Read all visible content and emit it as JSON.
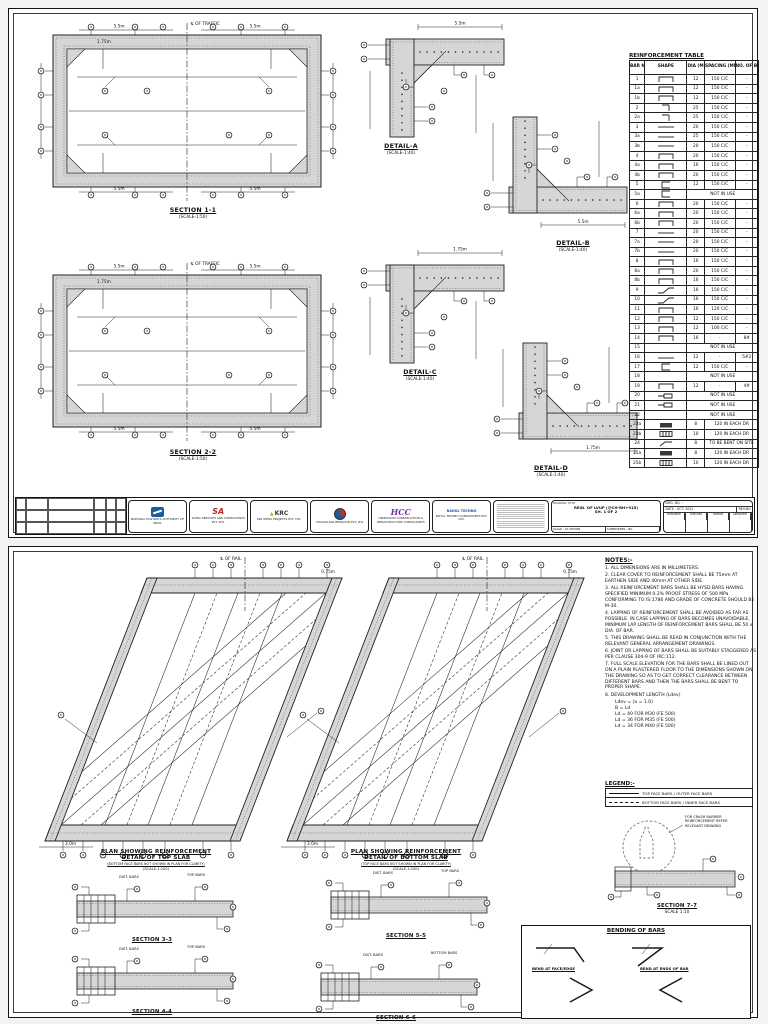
{
  "page1": {
    "s11": {
      "title": "SECTION 1-1",
      "scale": "(SCALE-1:50)",
      "centerline": "℄ OF TRAFFIC",
      "dims": {
        "a": "5.5m",
        "b": "5.5m",
        "c": "1.75m",
        "d": "5.5m",
        "e": "5.5m"
      }
    },
    "s22": {
      "title": "SECTION 2-2",
      "scale": "(SCALE-1:50)",
      "centerline": "℄ OF TRAFFIC",
      "dims": {
        "a": "5.5m",
        "b": "5.5m",
        "c": "1.75m",
        "d": "5.5m",
        "e": "5.5m"
      }
    },
    "details": {
      "a": {
        "title": "DETAIL-A",
        "scale": "(SCALE-1:40)",
        "dim": "5.5m"
      },
      "b": {
        "title": "DETAIL-B",
        "scale": "(SCALE-1:40)",
        "dim": "5.5m"
      },
      "c": {
        "title": "DETAIL-C",
        "scale": "(SCALE-1:40)",
        "dim": "1.75m"
      },
      "d": {
        "title": "DETAIL-D",
        "scale": "(SCALE-1:40)",
        "dim": "1.75m"
      }
    },
    "table": {
      "title": "REINFORCEMENT TABLE",
      "headers": [
        "BAR NO.",
        "SHAPE",
        "DIA (MM)",
        "SPACING (MM)",
        "NO. OF BARS"
      ],
      "rows": [
        {
          "no": "1",
          "shape": "u",
          "dia": "12",
          "spacing": "150 C/C",
          "bars": "-"
        },
        {
          "no": "1a",
          "shape": "u",
          "dia": "12",
          "spacing": "150 C/C",
          "bars": "-"
        },
        {
          "no": "1b",
          "shape": "u",
          "dia": "12",
          "spacing": "150 C/C",
          "bars": "-"
        },
        {
          "no": "2",
          "shape": "ldown",
          "dia": "25",
          "spacing": "150 C/C",
          "bars": "-"
        },
        {
          "no": "2a",
          "shape": "ldown",
          "dia": "25",
          "spacing": "150 C/C",
          "bars": "-"
        },
        {
          "no": "3",
          "shape": "line",
          "dia": "20",
          "spacing": "150 C/C",
          "bars": "-"
        },
        {
          "no": "3a",
          "shape": "line",
          "dia": "25",
          "spacing": "150 C/C",
          "bars": "-"
        },
        {
          "no": "3b",
          "shape": "line",
          "dia": "20",
          "spacing": "150 C/C",
          "bars": "-"
        },
        {
          "no": "4",
          "shape": "u",
          "dia": "20",
          "spacing": "150 C/C",
          "bars": "-"
        },
        {
          "no": "4a",
          "shape": "u",
          "dia": "16",
          "spacing": "150 C/C",
          "bars": "-"
        },
        {
          "no": "4b",
          "shape": "u",
          "dia": "20",
          "spacing": "150 C/C",
          "bars": "-"
        },
        {
          "no": "5",
          "shape": "c",
          "dia": "12",
          "spacing": "150 C/C",
          "bars": "-"
        },
        {
          "no": "5a",
          "shape": "c",
          "note": "NOT IN USE"
        },
        {
          "no": "6",
          "shape": "u",
          "dia": "20",
          "spacing": "150 C/C",
          "bars": "-"
        },
        {
          "no": "6a",
          "shape": "u",
          "dia": "20",
          "spacing": "150 C/C",
          "bars": "-"
        },
        {
          "no": "6b",
          "shape": "u",
          "dia": "20",
          "spacing": "150 C/C",
          "bars": "-"
        },
        {
          "no": "7",
          "shape": "line",
          "dia": "20",
          "spacing": "150 C/C",
          "bars": "-"
        },
        {
          "no": "7a",
          "shape": "line",
          "dia": "20",
          "spacing": "150 C/C",
          "bars": "-"
        },
        {
          "no": "7b",
          "shape": "line",
          "dia": "20",
          "spacing": "150 C/C",
          "bars": "-"
        },
        {
          "no": "8",
          "shape": "u",
          "dia": "16",
          "spacing": "150 C/C",
          "bars": "-"
        },
        {
          "no": "8a",
          "shape": "u",
          "dia": "20",
          "spacing": "150 C/C",
          "bars": "-"
        },
        {
          "no": "8b",
          "shape": "u",
          "dia": "16",
          "spacing": "150 C/C",
          "bars": "-"
        },
        {
          "no": "9",
          "shape": "crank",
          "dia": "16",
          "spacing": "150 C/C",
          "bars": "-"
        },
        {
          "no": "10",
          "shape": "crank",
          "dia": "16",
          "spacing": "150 C/C",
          "bars": "-"
        },
        {
          "no": "11",
          "shape": "u",
          "dia": "16",
          "spacing": "120 C/C",
          "bars": "-"
        },
        {
          "no": "12",
          "shape": "u",
          "dia": "12",
          "spacing": "150 C/C",
          "bars": "-"
        },
        {
          "no": "13",
          "shape": "u",
          "dia": "12",
          "spacing": "100 C/C",
          "bars": "-"
        },
        {
          "no": "14",
          "shape": "u",
          "dia": "16",
          "spacing": "-",
          "bars": "8#"
        },
        {
          "no": "15",
          "note": "NOT IN USE"
        },
        {
          "no": "16",
          "shape": "line",
          "dia": "12",
          "spacing": "-",
          "bars": "5#2"
        },
        {
          "no": "17",
          "shape": "c",
          "dia": "12",
          "spacing": "150 C/C",
          "bars": "-"
        },
        {
          "no": "18",
          "note": "NOT IN USE"
        },
        {
          "no": "19",
          "shape": "u",
          "dia": "12",
          "spacing": "-",
          "bars": "4#"
        },
        {
          "no": "20",
          "shape": "loop",
          "note": "NOT IN USE"
        },
        {
          "no": "21",
          "shape": "loop",
          "note": "NOT IN USE"
        },
        {
          "no": "22",
          "note": "NOT IN USE"
        },
        {
          "no": "23a",
          "shape": "plate",
          "dia": "8",
          "note2": "120 IN EACH DR"
        },
        {
          "no": "23b",
          "shape": "box",
          "dia": "10",
          "note2": "120 IN EACH DR"
        },
        {
          "no": "24",
          "shape": "tick",
          "dia": "8",
          "note2": "TO BE BENT ON SITE"
        },
        {
          "no": "25a",
          "shape": "plate",
          "dia": "8",
          "note2": "120 IN EACH DR"
        },
        {
          "no": "25b",
          "shape": "box",
          "dia": "10",
          "note2": "120 IN EACH DR"
        }
      ]
    },
    "titleblock": {
      "title_label": "DRAWING TITLE",
      "drawing_title": "REIN. OF LVUP (@CH-RH+915)",
      "sheet": "SH. 1 OF 2",
      "scale_note": "SCALE : AS SHOWN",
      "supersede": "SUPERSEDES : NIL",
      "drg_label": "DRG. NO. :",
      "date": "DATE : OCT. 2021",
      "rev": "REV.NO",
      "sign_labels": [
        "DESIGNED",
        "CHECKED",
        "DRAWN",
        "APPROVED"
      ],
      "sign_values": [
        "-",
        "-",
        "-",
        "-"
      ],
      "logos": [
        {
          "style": "nhai",
          "mark": "",
          "caption": "NATIONAL HIGHWAYS AUTHORITY OF INDIA"
        },
        {
          "style": "sa",
          "mark": "SA",
          "caption": "SATRA SERVICES AND CONSULTANTS PVT. LTD."
        },
        {
          "style": "krc",
          "mark": "KRC",
          "caption": "KRC INFRA PROJECTS PVT. LTD."
        },
        {
          "style": "disc",
          "mark": "",
          "caption": "CHAVAN RAILINFRACON PVT. LTD."
        },
        {
          "style": "hcc",
          "mark": "HCC",
          "caption": "HINDUSTAN CONSTRUCTION & INFRASTRUCTURE CONSULTANTS"
        },
        {
          "style": "blue",
          "mark": "RAHUL TECHNO",
          "caption": "RAHUL TECHNO CONSULTANTS PVT. LTD."
        }
      ]
    }
  },
  "page2": {
    "plans": [
      {
        "line1": "PLAN SHOWING REINFORCEMENT",
        "line2": "DETAIL OF TOP SLAB",
        "line3": "(BOTTOM FACE BARS NOT SHOWN IN PLAN FOR CLARITY)",
        "line4": "(SCALE-1:100)",
        "cl": "℄ OF RAIL",
        "dim1": "3.0m",
        "dim2": "0.75m"
      },
      {
        "line1": "PLAN SHOWING REINFORCEMENT",
        "line2": "DETAIL OF BOTTOM SLAB",
        "line3": "(TOP FACE BARS NOT SHOWN IN PLAN FOR CLARITY)",
        "line4": "(SCALE-1:100)",
        "cl": "℄ OF RAIL",
        "dim1": "3.0m",
        "dim2": "0.75m"
      }
    ],
    "notes": {
      "title": "NOTES:-",
      "items": [
        "1. ALL DIMENSIONS ARE IN MILLIMETERS.",
        "2. CLEAR COVER TO REINFORCEMENT SHALL BE 75mm AT EARTHEN SIDE AND 40mm AT OTHER SIDE.",
        "3. ALL REINFORCEMENT BARS SHALL BE HYSD BARS HAVING SPECIFIED MINIMUM 0.2% PROOF STRESS OF 500 MPa CONFORMING TO IS:1786 AND GRADE OF CONCRETE SHOULD BE M-30.",
        "4. LAPPING OF REINFORCEMENT SHALL BE AVOIDED AS FAR AS POSSIBLE. IN CASE LAPPING OF BARS BECOMES UNAVOIDABLE, MINIMUM LAP LENGTH OF REINFORCEMENT BARS SHALL BE 50 x DIA. OF BAR.",
        "5. THIS DRAWING SHALL BE READ IN CONJUNCTION WITH THE RELEVANT GENERAL ARRANGEMENT DRAWINGS.",
        "6. JOINT OR LAPPING OF BARS SHALL BE SUITABLY STAGGERED AS PER CLAUSE 304-9 OF IRC:112.",
        "7. FULL SCALE ELEVATION FOR THE BARS SHALL BE LINED OUT ON A PLAIN PLASTERED FLOOR TO THE DIMENSIONS SHOWN ON THE DRAWING SO AS TO GET CORRECT CLEARANCE BETWEEN DIFFERENT BARS AND THEN THE BARS SHALL BE BENT TO PROPER SHAPE.",
        "8. DEVELOPMENT LENGTH (Ldev)"
      ],
      "dev": [
        "Ldev = (a = 1.0)",
        "B = Ld",
        "Ld = 40 FOR M30 (FE 500)",
        "Ld = 36 FOR M35 (FE 500)",
        "Ld = 34 FOR M40 (FE 500)"
      ]
    },
    "legend": {
      "title": "LEGEND:-",
      "entries": [
        {
          "style": "solid",
          "label": "TOP FACE BARS / OUTER FACE BARS"
        },
        {
          "style": "dashed",
          "label": "BOTTOM FACE BARS / INNER FACE BARS"
        }
      ]
    },
    "sections": [
      {
        "title": "SECTION 3-3",
        "l1": "DIST. BARS",
        "l2": "TOP BARS"
      },
      {
        "title": "SECTION 5-5",
        "l1": "DIST. BARS",
        "l2": "TOP BARS"
      },
      {
        "title": "SECTION 4-4",
        "l1": "DIST. BARS",
        "l2": "TOP BARS"
      },
      {
        "title": "SECTION 6-6",
        "l1": "DIST. BARS",
        "l2": "BOTTOM BARS"
      }
    ],
    "sec7": {
      "title": "SECTION 7-7",
      "scale": "SCALE 1:10",
      "note": [
        "FOR CRASH BARRIER",
        "REINFORCEMENT REFER",
        "RELEVANT DRAWING"
      ]
    },
    "bending": {
      "title": "BENDING OF BARS",
      "cap1": "BEND AT FACE/EDGE",
      "cap2": "BEND AT ENDS OF BAR"
    }
  }
}
